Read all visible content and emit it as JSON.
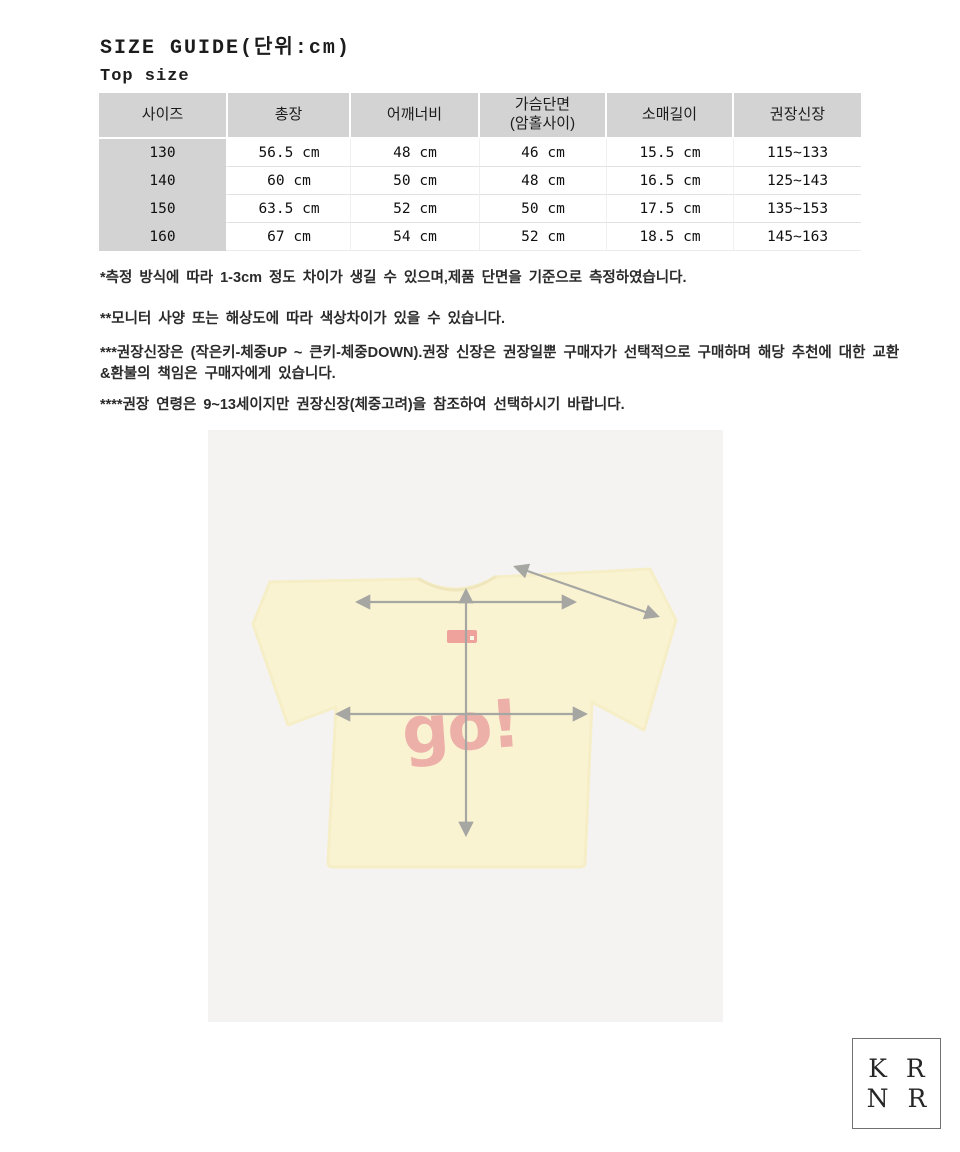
{
  "page": {
    "title": "SIZE GUIDE(단위:cm)",
    "subtitle": "Top size"
  },
  "table": {
    "columns": [
      "사이즈",
      "총장",
      "어깨너비",
      "가슴단면",
      "소매길이",
      "권장신장"
    ],
    "chest_sublabel": "(암홀사이)",
    "rows": [
      [
        "130",
        "56.5 cm",
        "48 cm",
        "46 cm",
        "15.5 cm",
        "115~133"
      ],
      [
        "140",
        "60 cm",
        "50 cm",
        "48 cm",
        "16.5 cm",
        "125~143"
      ],
      [
        "150",
        "63.5 cm",
        "52 cm",
        "50 cm",
        "17.5 cm",
        "135~153"
      ],
      [
        "160",
        "67 cm",
        "54 cm",
        "52 cm",
        "18.5 cm",
        "145~163"
      ]
    ]
  },
  "notes": [
    "*측정 방식에 따라 1-3cm 정도 차이가 생길 수 있으며,제품 단면을 기준으로 측정하였습니다.",
    "**모니터 사양 또는 해상도에 따라 색상차이가 있을 수 있습니다.",
    "***권장신장은 (작은키-체중UP ~ 큰키-체중DOWN).권장 신장은 권장일뿐 구매자가 선택적으로 구매하며 해당 추천에 대한 교환&환불의 책임은 구매자에게 있습니다.",
    "****권장 연령은 9~13세이지만 권장신장(체중고려)을 참조하여 선택하시기 바랍니다."
  ],
  "shirt": {
    "graphic_text": "go!"
  },
  "logo": {
    "letters": [
      "K",
      "R",
      "N",
      "R"
    ]
  },
  "colors": {
    "table_header_bg": "#d3d3d3",
    "image_bg": "#f4f3f1",
    "shirt_yellow": "#faf3d2",
    "arrow_gray": "#a6a6a2",
    "graphic_red": "#e9a0a0"
  }
}
